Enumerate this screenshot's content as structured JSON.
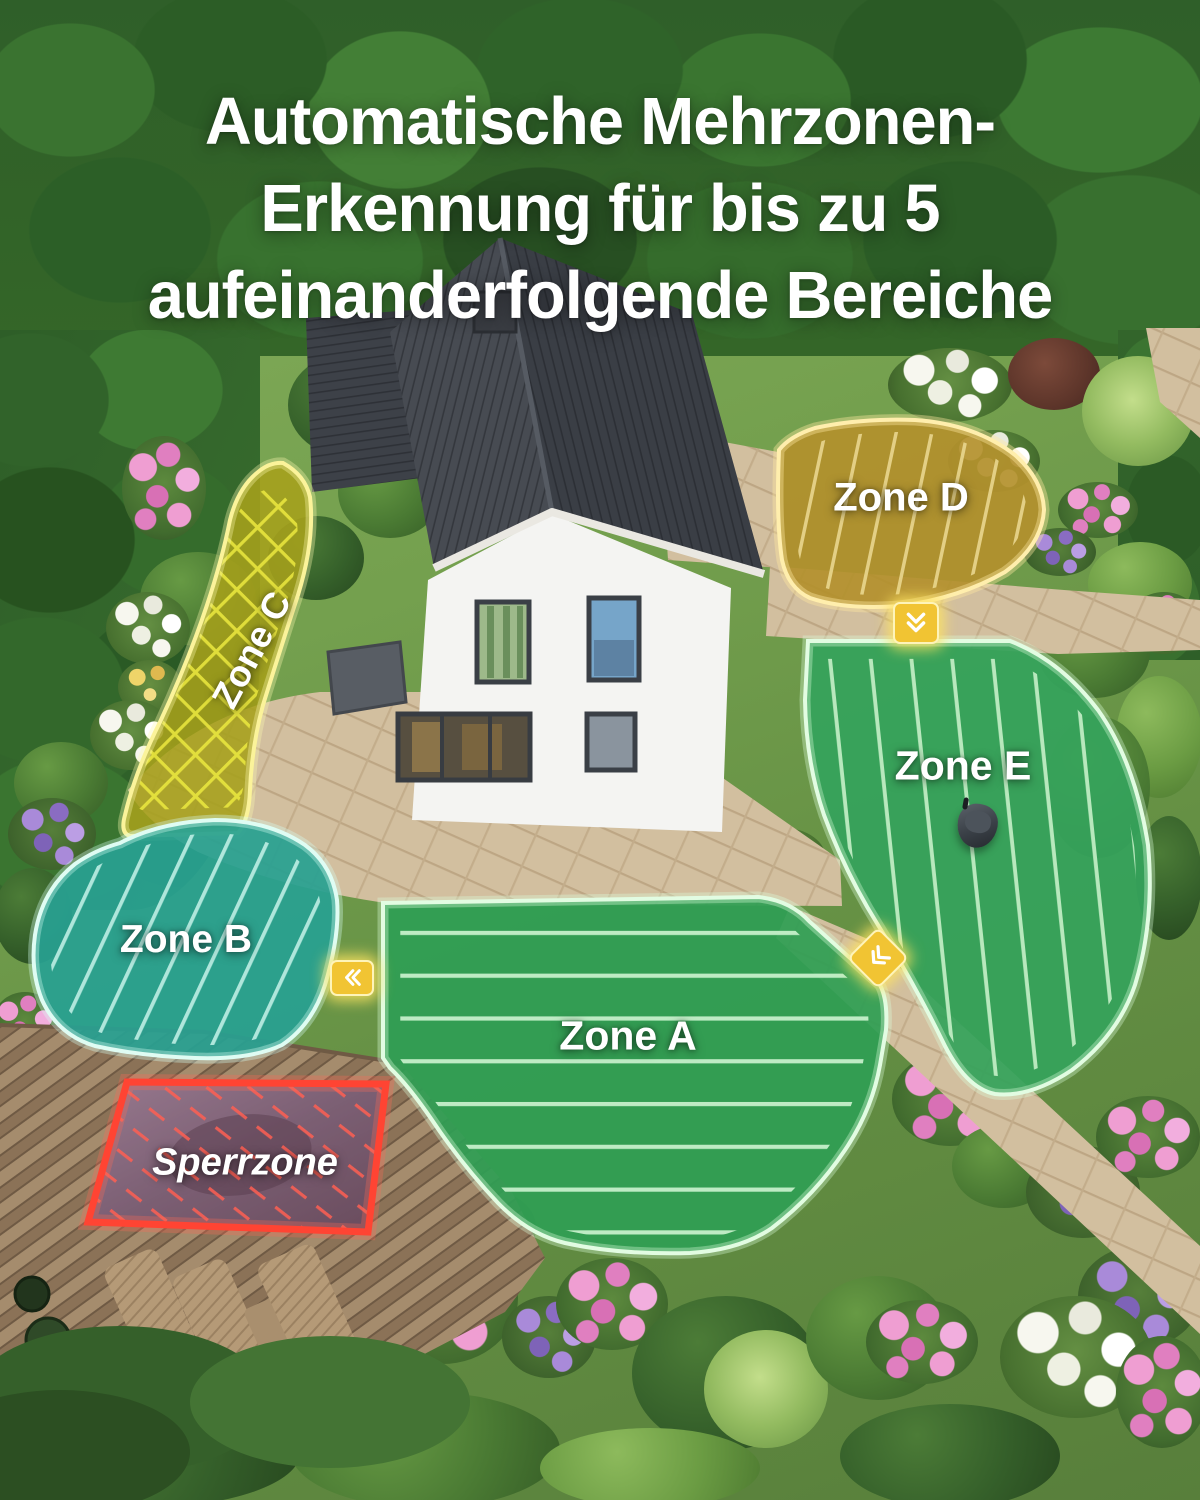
{
  "title": {
    "lines": [
      "Automatische Mehrzonen-",
      "Erkennung für bis zu 5",
      "aufeinanderfolgende Bereiche"
    ]
  },
  "zones": {
    "a": {
      "label": "Zone A",
      "fill": "#2f9e54",
      "stripe": "#cdf4d0"
    },
    "b": {
      "label": "Zone B",
      "fill": "#28a091",
      "stripe": "#bdeee4"
    },
    "c": {
      "label": "Zone C",
      "fill": "#a6a11b",
      "stripe": "#ece93f"
    },
    "d": {
      "label": "Zone D",
      "fill": "#b3902c",
      "stripe": "#e9d68e"
    },
    "e": {
      "label": "Zone E",
      "fill": "#35a35b",
      "stripe": "#c6f0c8"
    },
    "restricted": {
      "label": "Sperrzone",
      "border": "#ff4433",
      "hatch": "#ff5f52"
    }
  },
  "markers": {
    "d_to_e": {
      "icon": "chevron-double-down-icon",
      "color": "#f1c433"
    },
    "b_to_a": {
      "icon": "chevron-double-left-icon",
      "color": "#f1c433"
    },
    "e_to_a": {
      "icon": "chevron-double-down-left-icon",
      "color": "#f1c433"
    }
  },
  "objects": {
    "mower": {
      "icon": "robot-mower-icon"
    }
  },
  "accent_colors": {
    "title_text": "#ffffff",
    "label_text": "#ffffff"
  }
}
